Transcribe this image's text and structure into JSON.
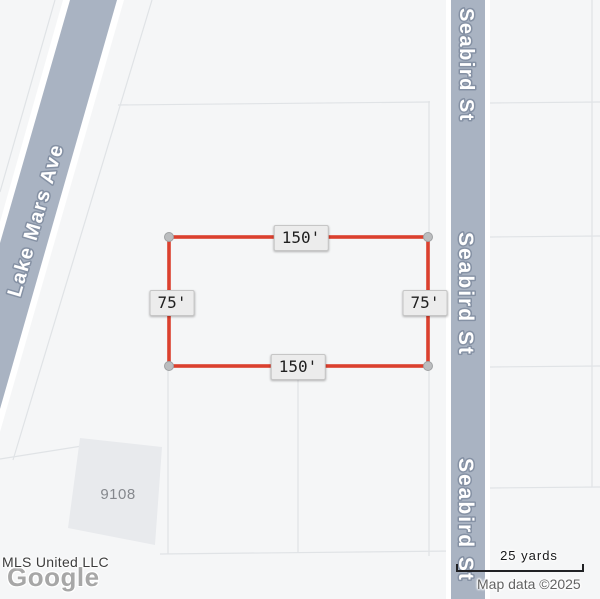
{
  "roads": {
    "lake_mars": "Lake Mars Ave",
    "seabird": "Seabird St"
  },
  "lot": {
    "top": "150'",
    "bottom": "150'",
    "left": "75'",
    "right": "75'"
  },
  "building": {
    "number": "9108"
  },
  "scale": {
    "label": "25 yards"
  },
  "footer": {
    "mls": "MLS United LLC",
    "google": "Google",
    "map_data": "Map data ©2025"
  },
  "colors": {
    "lot_outline": "#db402e",
    "road_fill": "#a9b3c2"
  }
}
